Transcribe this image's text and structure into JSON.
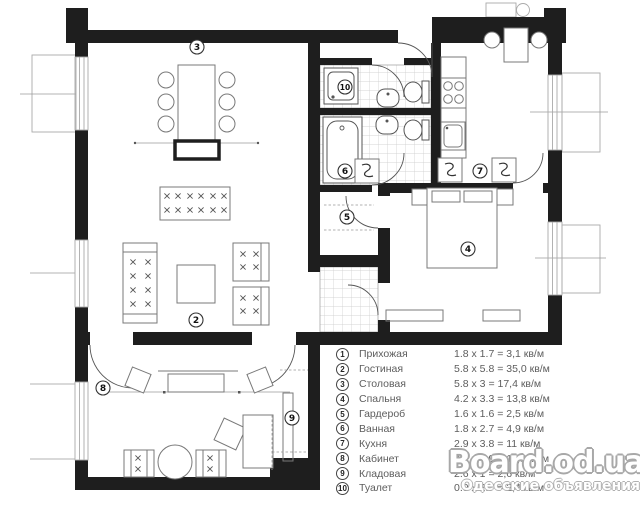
{
  "legend": {
    "rows": [
      {
        "num": "1",
        "name": "Прихожая",
        "dims": "1.8 x 1.7 = 3,1 кв/м"
      },
      {
        "num": "2",
        "name": "Гостиная",
        "dims": "5.8 x 5.8 = 35,0 кв/м"
      },
      {
        "num": "3",
        "name": "Столовая",
        "dims": "5.8 x 3 = 17,4 кв/м"
      },
      {
        "num": "4",
        "name": "Спальня",
        "dims": "4.2 x 3.3 = 13,8 кв/м"
      },
      {
        "num": "5",
        "name": "Гардероб",
        "dims": "1.6 x 1.6 = 2,5 кв/м"
      },
      {
        "num": "6",
        "name": "Ванная",
        "dims": "1.8 x 2.7 = 4,9 кв/м"
      },
      {
        "num": "7",
        "name": "Кухня",
        "dims": "2.9 x 3.8 = 11 кв/м"
      },
      {
        "num": "8",
        "name": "Кабинет",
        "dims": "2.4 x 4.9 = 11,8 кв/м"
      },
      {
        "num": "9",
        "name": "Кладовая",
        "dims": "2.6 x 1 = 2,6 кв/м"
      },
      {
        "num": "10",
        "name": "Туалет",
        "dims": "0.9 x 2.7 = 2,4 кв/м"
      }
    ]
  },
  "plan_labels": [
    {
      "num": "2",
      "x": 196,
      "y": 320
    },
    {
      "num": "3",
      "x": 197,
      "y": 47
    },
    {
      "num": "4",
      "x": 468,
      "y": 249
    },
    {
      "num": "5",
      "x": 347,
      "y": 217
    },
    {
      "num": "6",
      "x": 345,
      "y": 171
    },
    {
      "num": "7",
      "x": 480,
      "y": 171
    },
    {
      "num": "8",
      "x": 103,
      "y": 388
    },
    {
      "num": "9",
      "x": 292,
      "y": 418
    },
    {
      "num": "10",
      "x": 345,
      "y": 87
    }
  ],
  "watermark": {
    "title": "Board.od.ua",
    "subtitle": "Одесские объявления"
  },
  "colors": {
    "wall": "#1e1e1e",
    "furniture": "#787878",
    "tile": "#c9c9c9",
    "legend_text": "#5d5d5d",
    "watermark_outline": "#a8a8a8"
  }
}
